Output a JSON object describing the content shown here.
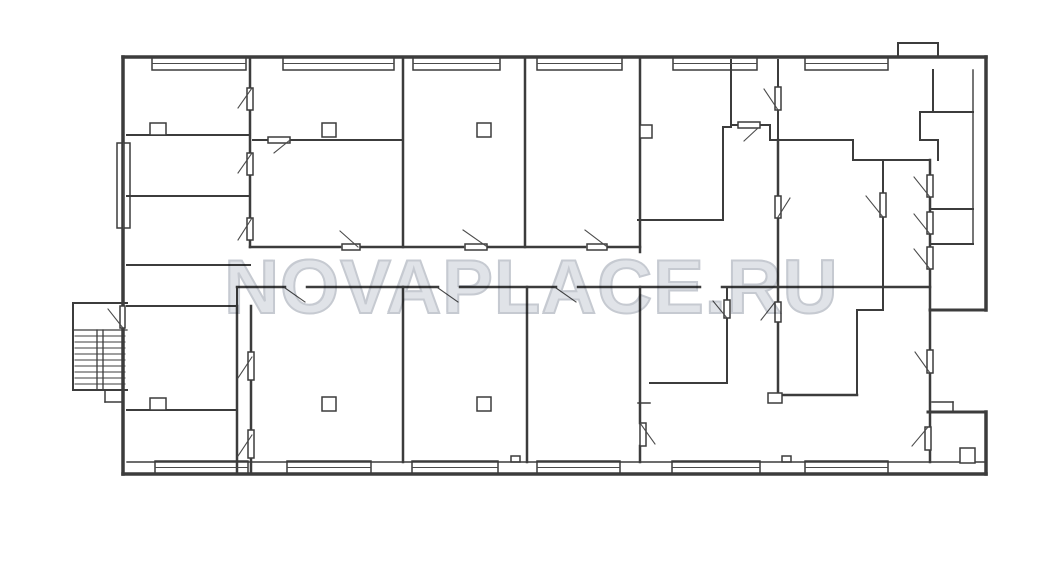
{
  "watermark": {
    "text": "NOVAPLACE.RU"
  },
  "canvas": {
    "w": 1063,
    "h": 570,
    "bg": "#ffffff"
  },
  "colors": {
    "wall": "#3c3c3c",
    "thin": "#4a4a4a",
    "fill": "#ffffff",
    "watermark_fill": "#e0e3e8",
    "watermark_stroke": "#c6cad1"
  },
  "plan": {
    "windows": [
      [
        152,
        57,
        94,
        13
      ],
      [
        283,
        57,
        111,
        13
      ],
      [
        413,
        57,
        87,
        13
      ],
      [
        537,
        57,
        85,
        13
      ],
      [
        673,
        57,
        84,
        13
      ],
      [
        805,
        57,
        83,
        13
      ],
      [
        155,
        461,
        93,
        13
      ],
      [
        287,
        461,
        84,
        13
      ],
      [
        412,
        461,
        86,
        13
      ],
      [
        537,
        461,
        83,
        13
      ],
      [
        672,
        461,
        88,
        13
      ],
      [
        805,
        461,
        83,
        13
      ],
      [
        117,
        143,
        13,
        85
      ],
      [
        511,
        456,
        9,
        6
      ],
      [
        782,
        456,
        9,
        6
      ]
    ],
    "lines": [
      [
        123,
        57,
        986,
        57,
        3.5
      ],
      [
        123,
        57,
        123,
        306,
        3.5
      ],
      [
        123,
        328,
        123,
        474,
        3.5
      ],
      [
        123,
        474,
        986,
        474,
        3.5
      ],
      [
        986,
        57,
        986,
        310,
        3.5
      ],
      [
        930,
        310,
        986,
        310,
        3
      ],
      [
        928,
        412,
        986,
        412,
        3
      ],
      [
        986,
        412,
        986,
        474,
        3.5
      ],
      [
        898,
        43,
        938,
        43,
        2
      ],
      [
        898,
        43,
        898,
        57,
        2
      ],
      [
        938,
        43,
        938,
        57,
        2
      ],
      [
        973,
        70,
        973,
        244,
        1.4
      ],
      [
        127,
        462,
        986,
        462,
        1.4
      ],
      [
        250,
        57,
        250,
        88,
        2.5
      ],
      [
        250,
        110,
        250,
        153,
        2.5
      ],
      [
        250,
        175,
        250,
        218,
        2.5
      ],
      [
        250,
        240,
        250,
        247,
        2.5
      ],
      [
        127,
        135,
        250,
        135,
        2
      ],
      [
        127,
        196,
        250,
        196,
        2
      ],
      [
        127,
        265,
        250,
        265,
        2
      ],
      [
        127,
        306,
        237,
        306,
        2
      ],
      [
        237,
        287,
        237,
        306,
        2
      ],
      [
        237,
        306,
        237,
        474,
        2.5
      ],
      [
        251,
        306,
        251,
        352,
        2.5
      ],
      [
        251,
        380,
        251,
        430,
        2.5
      ],
      [
        251,
        458,
        251,
        474,
        2.5
      ],
      [
        127,
        410,
        237,
        410,
        2
      ],
      [
        250,
        247,
        340,
        247,
        2.5
      ],
      [
        360,
        247,
        463,
        247,
        2.5
      ],
      [
        487,
        247,
        585,
        247,
        2.5
      ],
      [
        607,
        247,
        640,
        247,
        2.5
      ],
      [
        237,
        287,
        285,
        287,
        2.5
      ],
      [
        307,
        287,
        438,
        287,
        2.5
      ],
      [
        460,
        287,
        556,
        287,
        2.5
      ],
      [
        578,
        287,
        700,
        287,
        2.5
      ],
      [
        722,
        287,
        930,
        287,
        2.5
      ],
      [
        403,
        57,
        403,
        247,
        2.5
      ],
      [
        253,
        140,
        268,
        140,
        2
      ],
      [
        290,
        140,
        403,
        140,
        2
      ],
      [
        525,
        57,
        525,
        247,
        2.5
      ],
      [
        640,
        57,
        640,
        252,
        2.5
      ],
      [
        638,
        220,
        723,
        220,
        2
      ],
      [
        723,
        127,
        723,
        220,
        2
      ],
      [
        731,
        60,
        731,
        127,
        2
      ],
      [
        723,
        127,
        731,
        127,
        2
      ],
      [
        731,
        125,
        738,
        125,
        2
      ],
      [
        760,
        125,
        770,
        125,
        2
      ],
      [
        770,
        125,
        770,
        140,
        2
      ],
      [
        770,
        140,
        853,
        140,
        2
      ],
      [
        778,
        60,
        778,
        87,
        2
      ],
      [
        778,
        110,
        778,
        140,
        2
      ],
      [
        778,
        140,
        778,
        197,
        2.5
      ],
      [
        778,
        217,
        778,
        302,
        2.5
      ],
      [
        778,
        322,
        778,
        397,
        2.5
      ],
      [
        853,
        140,
        853,
        160,
        2
      ],
      [
        853,
        160,
        930,
        160,
        2
      ],
      [
        883,
        160,
        883,
        193,
        2
      ],
      [
        883,
        217,
        883,
        310,
        2
      ],
      [
        930,
        160,
        930,
        350,
        2.5
      ],
      [
        930,
        373,
        930,
        427,
        2.5
      ],
      [
        930,
        450,
        930,
        462,
        2.5
      ],
      [
        930,
        209,
        973,
        209,
        2
      ],
      [
        930,
        244,
        973,
        244,
        2
      ],
      [
        933,
        70,
        933,
        112,
        2
      ],
      [
        920,
        112,
        973,
        112,
        2
      ],
      [
        920,
        112,
        920,
        140,
        2
      ],
      [
        920,
        140,
        938,
        140,
        2
      ],
      [
        938,
        140,
        938,
        160,
        2
      ],
      [
        857,
        310,
        883,
        310,
        2
      ],
      [
        857,
        310,
        857,
        393,
        2
      ],
      [
        778,
        395,
        857,
        395,
        2.5
      ],
      [
        403,
        287,
        403,
        462,
        2.5
      ],
      [
        527,
        287,
        527,
        462,
        2.5
      ],
      [
        640,
        287,
        640,
        423,
        2.5
      ],
      [
        640,
        446,
        640,
        462,
        2.5
      ],
      [
        638,
        403,
        650,
        403,
        1.5
      ],
      [
        650,
        383,
        727,
        383,
        2
      ],
      [
        727,
        287,
        727,
        300,
        2
      ],
      [
        727,
        318,
        727,
        383,
        2
      ],
      [
        932,
        402,
        953,
        402,
        1.5
      ],
      [
        953,
        402,
        953,
        412,
        1.5
      ],
      [
        73,
        303,
        127,
        303,
        2
      ],
      [
        73,
        303,
        73,
        390,
        2
      ],
      [
        73,
        390,
        127,
        390,
        2
      ],
      [
        73,
        330,
        127,
        330,
        1.3
      ],
      [
        75,
        336,
        125,
        336,
        1
      ],
      [
        75,
        342,
        125,
        342,
        1
      ],
      [
        75,
        348,
        125,
        348,
        1
      ],
      [
        75,
        354,
        125,
        354,
        1
      ],
      [
        75,
        360,
        125,
        360,
        1
      ],
      [
        75,
        366,
        125,
        366,
        1
      ],
      [
        75,
        372,
        125,
        372,
        1
      ],
      [
        75,
        378,
        125,
        378,
        1
      ],
      [
        75,
        384,
        125,
        384,
        1
      ],
      [
        97,
        330,
        97,
        390,
        1.3
      ],
      [
        103,
        330,
        103,
        390,
        1.3
      ],
      [
        105,
        390,
        105,
        402,
        1.5
      ],
      [
        105,
        402,
        123,
        402,
        1.5
      ]
    ],
    "over_rects": [
      [
        247,
        88,
        6,
        22
      ],
      [
        247,
        153,
        6,
        22
      ],
      [
        247,
        218,
        6,
        22
      ],
      [
        268,
        137,
        22,
        6
      ],
      [
        342,
        244,
        18,
        6
      ],
      [
        465,
        244,
        22,
        6
      ],
      [
        587,
        244,
        20,
        6
      ],
      [
        248,
        352,
        6,
        28
      ],
      [
        248,
        430,
        6,
        28
      ],
      [
        738,
        122,
        22,
        6
      ],
      [
        775,
        87,
        6,
        23
      ],
      [
        775,
        196,
        6,
        22
      ],
      [
        775,
        302,
        6,
        20
      ],
      [
        724,
        300,
        6,
        18
      ],
      [
        880,
        193,
        6,
        24
      ],
      [
        927,
        175,
        6,
        22
      ],
      [
        927,
        212,
        6,
        22
      ],
      [
        927,
        247,
        6,
        22
      ],
      [
        927,
        350,
        6,
        23
      ],
      [
        925,
        427,
        6,
        23
      ],
      [
        640,
        423,
        6,
        23
      ],
      [
        120,
        306,
        5,
        22
      ],
      [
        322,
        123,
        14,
        14
      ],
      [
        477,
        123,
        14,
        14
      ],
      [
        640,
        125,
        12,
        13
      ],
      [
        322,
        397,
        14,
        14
      ],
      [
        477,
        397,
        14,
        14
      ],
      [
        150,
        123,
        16,
        12
      ],
      [
        150,
        398,
        16,
        12
      ],
      [
        960,
        448,
        15,
        15
      ],
      [
        768,
        393,
        14,
        10
      ]
    ],
    "thin_lines": [
      [
        252,
        88,
        238,
        108
      ],
      [
        252,
        153,
        238,
        173
      ],
      [
        252,
        218,
        238,
        240
      ],
      [
        290,
        140,
        274,
        153
      ],
      [
        340,
        231,
        358,
        247
      ],
      [
        463,
        230,
        486,
        246
      ],
      [
        585,
        230,
        606,
        246
      ],
      [
        285,
        288,
        305,
        302
      ],
      [
        438,
        288,
        458,
        302
      ],
      [
        556,
        288,
        576,
        302
      ],
      [
        252,
        357,
        238,
        378
      ],
      [
        252,
        435,
        238,
        456
      ],
      [
        758,
        128,
        744,
        141
      ],
      [
        778,
        110,
        764,
        89
      ],
      [
        778,
        217,
        790,
        198
      ],
      [
        775,
        302,
        761,
        320
      ],
      [
        727,
        318,
        713,
        301
      ],
      [
        883,
        217,
        866,
        196
      ],
      [
        930,
        197,
        914,
        177
      ],
      [
        930,
        234,
        914,
        214
      ],
      [
        930,
        269,
        914,
        249
      ],
      [
        930,
        373,
        915,
        352
      ],
      [
        928,
        427,
        912,
        446
      ],
      [
        640,
        423,
        655,
        444
      ],
      [
        123,
        328,
        108,
        309
      ],
      [
        152,
        63.5,
        246,
        63.5
      ],
      [
        283,
        63.5,
        394,
        63.5
      ],
      [
        413,
        63.5,
        500,
        63.5
      ],
      [
        537,
        63.5,
        622,
        63.5
      ],
      [
        673,
        63.5,
        757,
        63.5
      ],
      [
        805,
        63.5,
        888,
        63.5
      ],
      [
        155,
        467.5,
        248,
        467.5
      ],
      [
        287,
        467.5,
        371,
        467.5
      ],
      [
        412,
        467.5,
        498,
        467.5
      ],
      [
        537,
        467.5,
        620,
        467.5
      ],
      [
        672,
        467.5,
        760,
        467.5
      ],
      [
        805,
        467.5,
        888,
        467.5
      ],
      [
        123.5,
        143,
        123.5,
        228
      ]
    ]
  }
}
